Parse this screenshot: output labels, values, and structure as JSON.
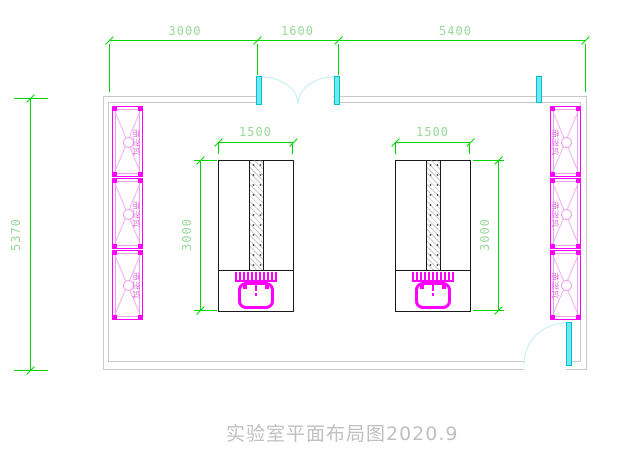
{
  "title": "实验室平面布局图2020.9",
  "dims": {
    "top_left": "3000",
    "top_mid": "1600",
    "top_right": "5400",
    "room_height": "5370",
    "bench_left_width": "1500",
    "bench_left_length": "3000",
    "bench_right_width": "1500",
    "bench_right_length": "3000"
  },
  "cabinets": {
    "left": [
      {
        "label": "试剂柜"
      },
      {
        "label": "试剂柜"
      },
      {
        "label": "试剂柜"
      }
    ],
    "right": [
      {
        "label": "试剂柜"
      },
      {
        "label": "试剂柜"
      },
      {
        "label": "试剂柜"
      }
    ]
  },
  "colors": {
    "dim_line": "#00d400",
    "dim_text": "#9cd89c",
    "wall": "#c9c9c9",
    "bench": "#1a1a1a",
    "magenta": "#ff00ff",
    "magenta_pale": "#f0a0f0",
    "cabinet_text": "#e06ae0",
    "door_fill": "#6fe9ef",
    "door_border": "#00c0cc",
    "door_arc": "#bfeef2",
    "title_text": "#c0c0c0"
  }
}
